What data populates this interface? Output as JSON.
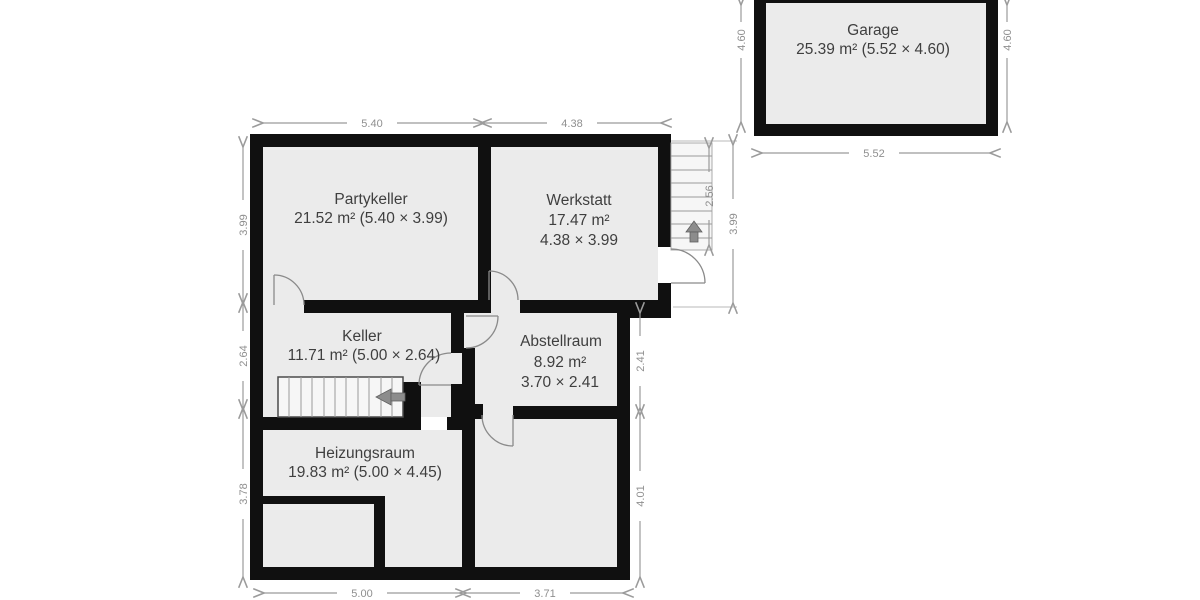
{
  "garage": {
    "name": "Garage",
    "area": "25.39 m² (5.52 × 4.60)",
    "dim_left": "4.60",
    "dim_right": "4.60",
    "dim_bottom": "5.52"
  },
  "rooms": {
    "partykeller": {
      "name": "Partykeller",
      "area": "21.52 m² (5.40 × 3.99)"
    },
    "werkstatt": {
      "name": "Werkstatt",
      "area": "17.47 m²",
      "size": "4.38 × 3.99"
    },
    "keller": {
      "name": "Keller",
      "area": "11.71 m² (5.00 × 2.64)"
    },
    "abstellraum": {
      "name": "Abstellraum",
      "area": "8.92 m²",
      "size": "3.70 × 2.41"
    },
    "heizungsraum": {
      "name": "Heizungsraum",
      "area": "19.83 m² (5.00 × 4.45)"
    }
  },
  "dims": {
    "top_left": "5.40",
    "top_right": "4.38",
    "left_top": "3.99",
    "left_mid": "2.64",
    "left_bottom": "3.78",
    "right_top": "3.99",
    "stairs": "2.56",
    "right_mid": "2.41",
    "right_bottom": "4.01",
    "bottom_left": "5.00",
    "bottom_right": "3.71"
  },
  "colors": {
    "wall": "#101010",
    "room_fill": "#ebebeb",
    "dimension": "#9b9b9b",
    "label_text": "#3f3f3f",
    "stair_arrow": "#8c8c8c"
  }
}
